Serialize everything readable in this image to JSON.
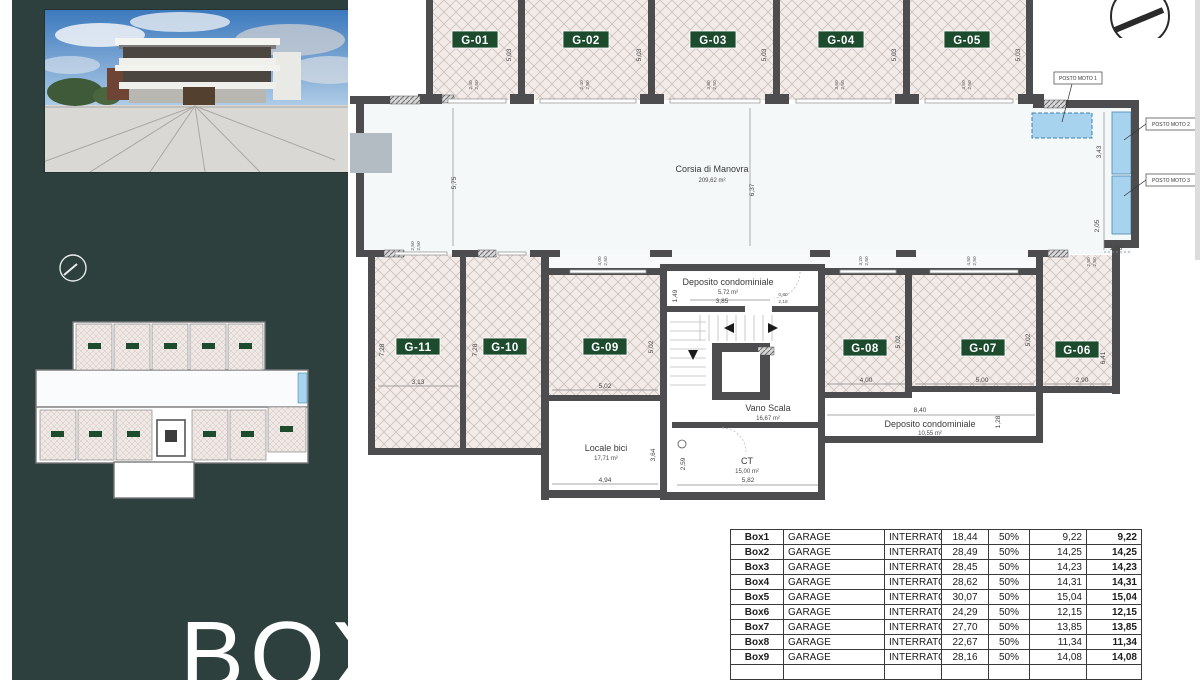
{
  "sidebar": {
    "title": "BOX"
  },
  "plan": {
    "garage_labels_top": [
      "G-01",
      "G-02",
      "G-03",
      "G-04",
      "G-05"
    ],
    "garage_labels_bottom": [
      "G-11",
      "G-10",
      "G-09",
      "G-08",
      "G-07",
      "G-06"
    ],
    "rooms": {
      "corsia": {
        "name": "Corsia di Manovra",
        "area": "209,62 m²"
      },
      "deposito1": {
        "name": "Deposito condominiale",
        "area": "5,72 m²"
      },
      "vano_scala": {
        "name": "Vano Scala",
        "area": "16,67 m²"
      },
      "locale_bici": {
        "name": "Locale bici",
        "area": "17,71 m²"
      },
      "ct": {
        "name": "CT",
        "area": "15,00 m²"
      },
      "deposito2": {
        "name": "Deposito condominiale",
        "area": "10,55 m²"
      }
    },
    "posto_moto": [
      "POSTO MOTO 1",
      "POSTO MOTO 2",
      "POSTO MOTO 3"
    ],
    "dims": {
      "d503": "5,03",
      "d575": "5,75",
      "d637": "6,37",
      "d728": "7,28",
      "d313": "3,13",
      "d502": "5,02",
      "d385": "3,85",
      "d149": "1,49",
      "d080": "0,80",
      "d218": "2,18",
      "d494": "4,94",
      "d364": "3,64",
      "d582": "5,82",
      "d259": "2,59",
      "d400": "4,00",
      "d500": "5,00",
      "d641": "6,41",
      "d290": "2,90",
      "d840": "8,40",
      "d128": "1,28",
      "d343": "3,43",
      "d205": "2,05",
      "d188": "1,88"
    },
    "openings": [
      {
        "a": "2,40",
        "b": "2,50"
      },
      {
        "a": "3,60",
        "b": "2,50"
      },
      {
        "a": "4,50",
        "b": "2,50"
      },
      {
        "a": "4,00",
        "b": "2,50"
      },
      {
        "a": "3,20",
        "b": "2,50"
      },
      {
        "a": "2,50",
        "b": "2,50"
      }
    ],
    "colors": {
      "accent_green": "#1c4b2d",
      "moto_blue": "#a8d3ee",
      "wall_gray": "#4d4d4f"
    }
  },
  "table": {
    "rows": [
      {
        "id": "Box1",
        "type": "GARAGE",
        "floor": "INTERRATO",
        "area": "18,44",
        "pct": "50%",
        "half": "9,22",
        "total": "9,22"
      },
      {
        "id": "Box2",
        "type": "GARAGE",
        "floor": "INTERRATO",
        "area": "28,49",
        "pct": "50%",
        "half": "14,25",
        "total": "14,25"
      },
      {
        "id": "Box3",
        "type": "GARAGE",
        "floor": "INTERRATO",
        "area": "28,45",
        "pct": "50%",
        "half": "14,23",
        "total": "14,23"
      },
      {
        "id": "Box4",
        "type": "GARAGE",
        "floor": "INTERRATO",
        "area": "28,62",
        "pct": "50%",
        "half": "14,31",
        "total": "14,31"
      },
      {
        "id": "Box5",
        "type": "GARAGE",
        "floor": "INTERRATO",
        "area": "30,07",
        "pct": "50%",
        "half": "15,04",
        "total": "15,04"
      },
      {
        "id": "Box6",
        "type": "GARAGE",
        "floor": "INTERRATO",
        "area": "24,29",
        "pct": "50%",
        "half": "12,15",
        "total": "12,15"
      },
      {
        "id": "Box7",
        "type": "GARAGE",
        "floor": "INTERRATO",
        "area": "27,70",
        "pct": "50%",
        "half": "13,85",
        "total": "13,85"
      },
      {
        "id": "Box8",
        "type": "GARAGE",
        "floor": "INTERRATO",
        "area": "22,67",
        "pct": "50%",
        "half": "11,34",
        "total": "11,34"
      },
      {
        "id": "Box9",
        "type": "GARAGE",
        "floor": "INTERRATO",
        "area": "28,16",
        "pct": "50%",
        "half": "14,08",
        "total": "14,08"
      }
    ]
  }
}
